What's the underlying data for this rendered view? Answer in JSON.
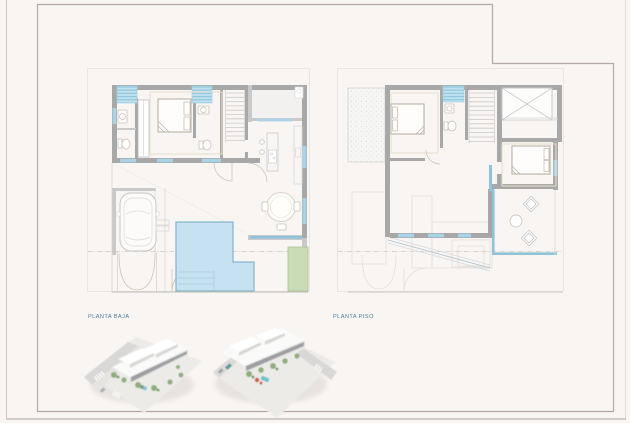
{
  "sheet": {
    "plan_left_label": "PLANTA BAJA",
    "plan_right_label": "PLANTA PISO"
  },
  "figures": {
    "left_render": "3d-aerial-render-street-corner-view",
    "right_render": "3d-aerial-render-rear-corner-view"
  },
  "colors": {
    "background": "#f9f5f3",
    "frame": "#b3a7a2",
    "sheet_edge": "#cfc4bf",
    "wall": "#a8a8a8",
    "wall_light": "#c9c9c9",
    "line_light": "#d9d9d9",
    "line_ghost": "#e4ded8",
    "dash_line": "#cfc9c3",
    "floor_trim": "#e8e0c8",
    "fixture": "#c9c2b4",
    "window_blue": "#8fc3dc",
    "sill_blue": "#a9d3e6",
    "skylight": "#bfe0ee",
    "skylight_stripe": "#8fc6dc",
    "pool_fill": "#c6e1ef",
    "pool_edge": "#86b7cf",
    "pool_steps": "#a8cde0",
    "green_fill": "#c9dcb6",
    "green_edge": "#a9c494",
    "label_text": "#4d7d9e",
    "render_tree": "#8fae7e",
    "render_road": "#d9d8d6",
    "render_face": "#e8e7e4",
    "render_window": "#8f9296",
    "render_water": "#7fc0cb",
    "render_red": "#c4604c"
  }
}
